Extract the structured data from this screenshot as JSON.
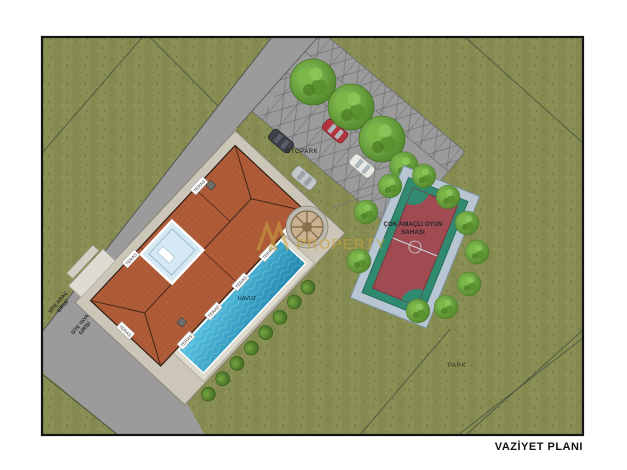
{
  "title": "VAZİYET PLANI",
  "watermark": {
    "logo": "chevron-monogram",
    "text": "PROPERTY",
    "color": "#c9a23f"
  },
  "site": {
    "labels": {
      "parking": "OTOPARK",
      "pool": "HAVUZ",
      "park": "PARK",
      "court_line1": "ÇOK AMAÇLI OYUN",
      "court_line2": "SAHASI",
      "terrace": "TERAS",
      "vehicle_entrance_line1": "SİTE ARAÇ",
      "vehicle_entrance_line2": "GİRİŞİ",
      "pedestrian_entrance_line1": "SİTE YAYA",
      "pedestrian_entrance_line2": "GİRİŞİ"
    },
    "colors": {
      "grass": "#8a9055",
      "road": "#9b9b9b",
      "roof": "#b05c38",
      "pool_water": "#2e9cc3",
      "atrium_glass": "#d5e9f4",
      "court_field": "#a04a52",
      "court_band": "#2f8a70",
      "court_deck": "#b7c6d2",
      "apron": "#ccc6b8",
      "tree": "#5f9a33",
      "car_red": "#b3343c"
    }
  }
}
